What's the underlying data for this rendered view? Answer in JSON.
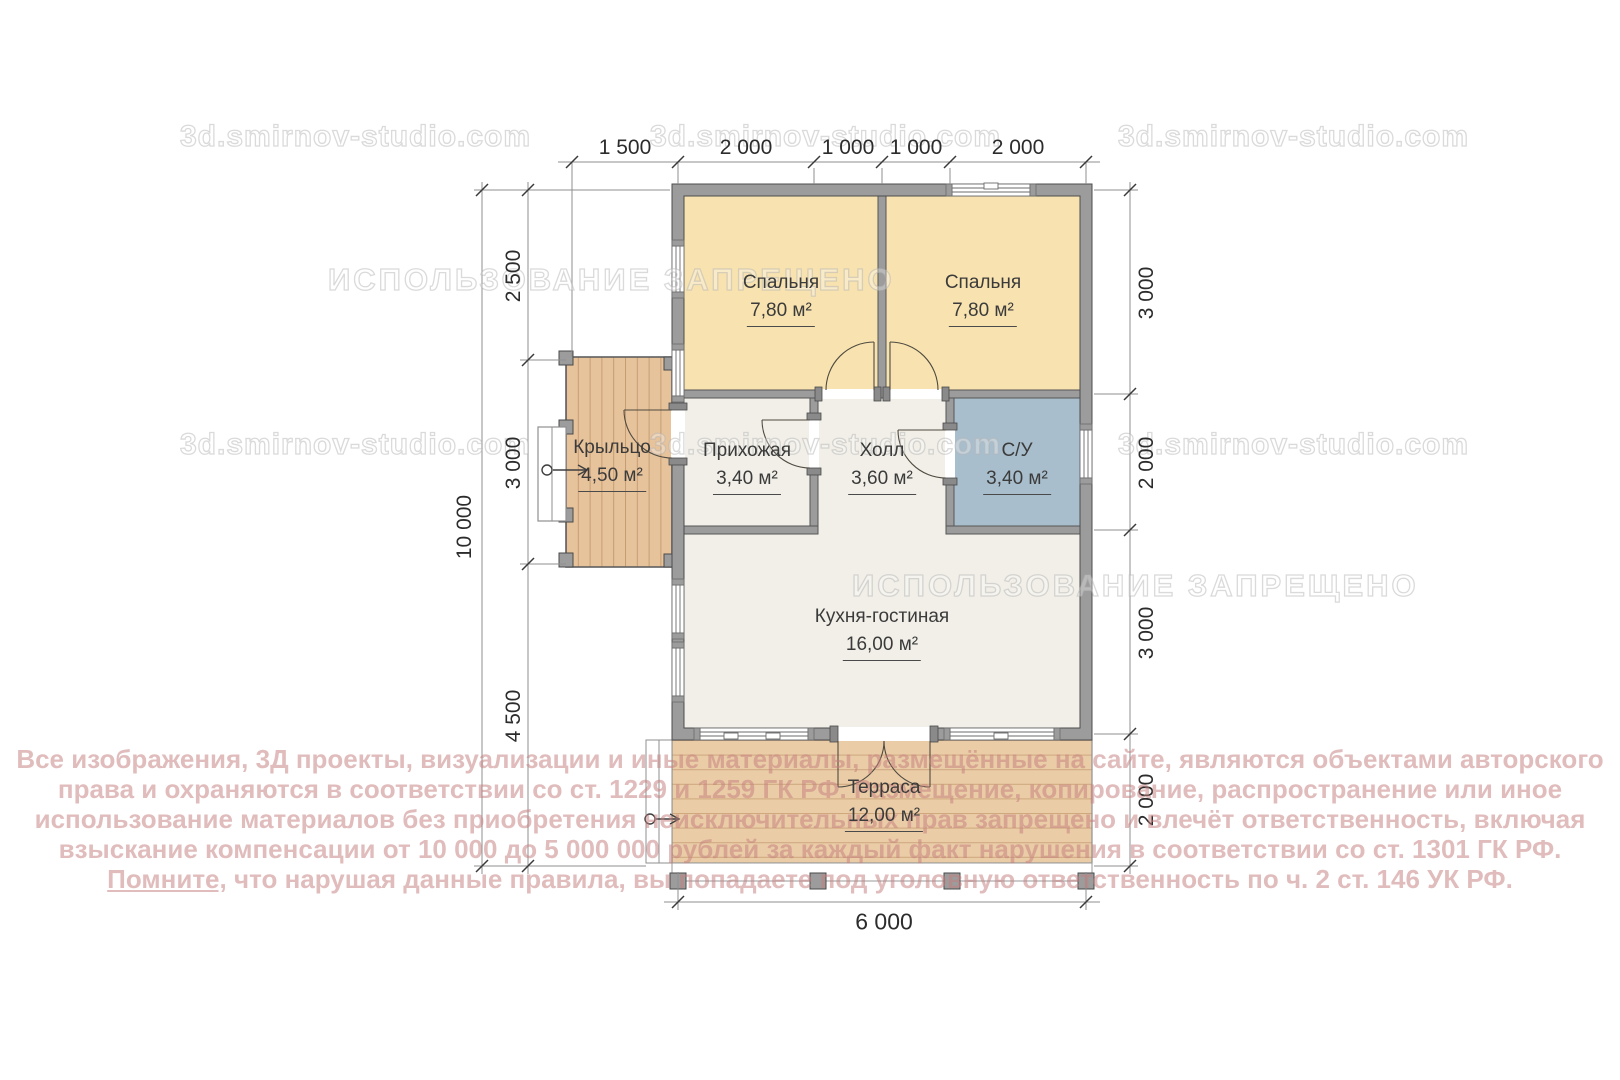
{
  "watermark": {
    "site": "3d.smirnov-studio.com",
    "ban": "ИСПОЛЬЗОВАНИЕ ЗАПРЕЩЕНО"
  },
  "rooms": {
    "bedroom1": {
      "name": "Спальня",
      "area": "7,80 м²"
    },
    "bedroom2": {
      "name": "Спальня",
      "area": "7,80 м²"
    },
    "hallway": {
      "name": "Прихожая",
      "area": "3,40 м²"
    },
    "hall": {
      "name": "Холл",
      "area": "3,60 м²"
    },
    "bathroom": {
      "name": "С/У",
      "area": "3,40 м²"
    },
    "kitchen": {
      "name": "Кухня-гостиная",
      "area": "16,00 м²"
    },
    "porch": {
      "name": "Крыльцо",
      "area": "4,50 м²"
    },
    "terrace": {
      "name": "Терраса",
      "area": "12,00 м²"
    }
  },
  "dimensions": {
    "top": [
      "1 500",
      "2 000",
      "1 000",
      "1 000",
      "2 000"
    ],
    "left_total": "10 000",
    "left": [
      "2 500",
      "3 000",
      "4 500"
    ],
    "right": [
      "3 000",
      "2 000",
      "3 000",
      "2 000"
    ],
    "bottom": "6 000"
  },
  "copyright": {
    "line1": "Все изображения, 3Д проекты, визуализации и иные материалы, размещённые на сайте, являются объектами авторского",
    "line2": "права и охраняются в соответствии со ст. 1229 и 1259 ГК РФ. Размещение, копирование, распространение или иное",
    "line3": "использование материалов без приобретения неисключительных прав запрещено и влечёт ответственность, включая",
    "line4": "взыскание компенсации от 10 000 до 5 000 000 рублей за каждый факт нарушения в соответствии со ст. 1301 ГК РФ.",
    "line5_underlined": "Помните,",
    "line5_rest": " что нарушая данные правила, вы попадаете под уголовную ответственность по ч. 2 ст. 146 УК РФ."
  },
  "colors": {
    "bedroom_fill": "#F8E3B0",
    "bathroom_fill": "#A9BECC",
    "living_fill": "#F1EFE7",
    "wood_fill": "#EACCA7",
    "wood_line": "#CFA77D",
    "wall_fill": "#9C9C9C",
    "wall_stroke": "#4d4d4d",
    "dimension_text": "#2c2c2c",
    "copyright_text": "#C67E7E"
  }
}
